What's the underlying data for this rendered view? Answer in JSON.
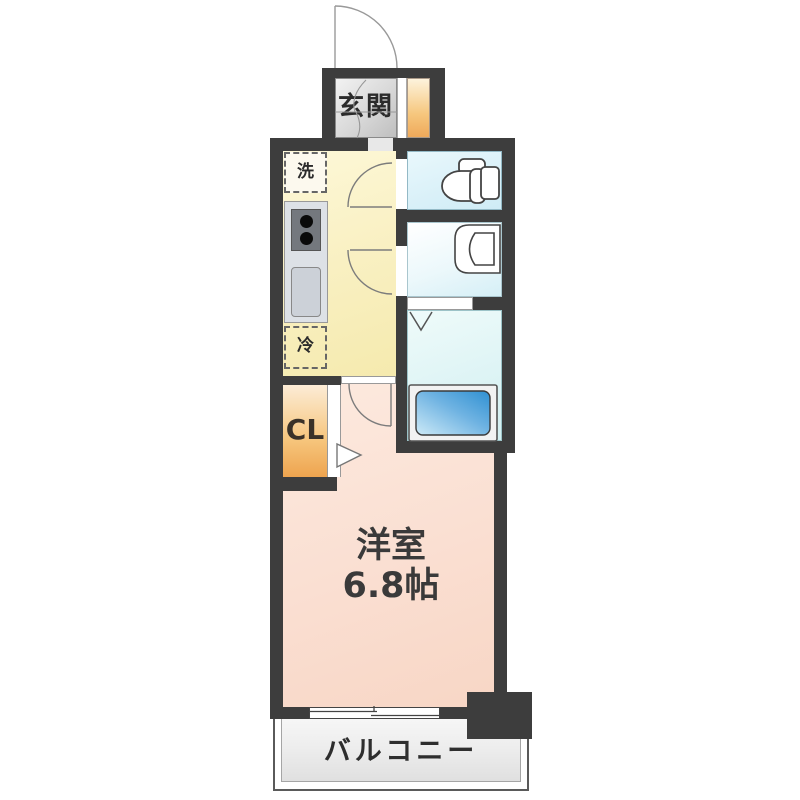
{
  "floorplan": {
    "type": "apartment-floor-plan",
    "labels": {
      "entrance": "玄関",
      "washer_space": "洗",
      "fridge_space": "冷",
      "closet": "CL",
      "main_room_name": "洋室",
      "main_room_size": "6.8帖",
      "balcony": "バルコニー"
    },
    "rooms": [
      {
        "name": "玄関",
        "kind": "entrance"
      },
      {
        "name": "キッチン",
        "kind": "kitchen"
      },
      {
        "name": "トイレ",
        "kind": "toilet"
      },
      {
        "name": "洗面室",
        "kind": "washroom"
      },
      {
        "name": "浴室",
        "kind": "bathroom"
      },
      {
        "name": "CL",
        "kind": "closet"
      },
      {
        "name": "洋室 6.8帖",
        "kind": "main-room"
      },
      {
        "name": "バルコニー",
        "kind": "balcony"
      }
    ],
    "colors": {
      "wall": "#3d3d3d",
      "kitchen_floor": "#f9f0c2",
      "main_room_floor": "#fadfd2",
      "toilet_floor": "#d9f0f8",
      "bath_floor": "#def4f5",
      "washroom_floor": "#e8f5f9",
      "closet_top": "#fcecd6",
      "closet_bottom": "#eea44f",
      "genkan_floor": "#d8d8d8",
      "bathtub_blue": "#2f90d2",
      "balcony_fill": "#ececec"
    }
  }
}
